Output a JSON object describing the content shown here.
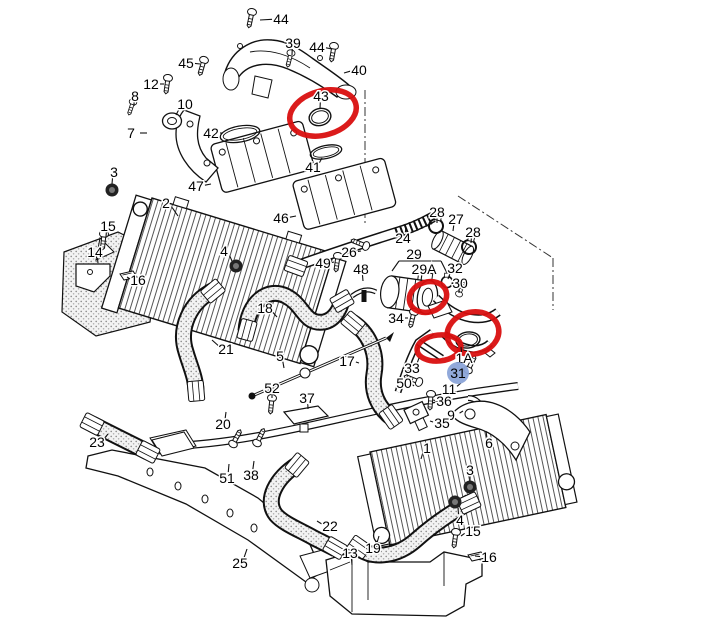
{
  "page": {
    "background": "#ffffff",
    "width": 720,
    "height": 622
  },
  "colors": {
    "line_art": "#111111",
    "annotation_red": "#d90f0f",
    "highlight_blue": "#8ba4d8",
    "label_text": "#000000"
  },
  "diagram": {
    "description": "Exploded parts diagram - charge air intercooler system with hoses, manifolds, throttle body and mounting hardware",
    "highlighted_label": {
      "text": "31",
      "x": 458,
      "y": 373,
      "r": 11
    },
    "labels": [
      {
        "t": "44",
        "x": 281,
        "y": 19,
        "tx": 260,
        "ty": 20
      },
      {
        "t": "39",
        "x": 293,
        "y": 43,
        "tx": 292,
        "ty": 55
      },
      {
        "t": "44",
        "x": 317,
        "y": 47,
        "tx": 332,
        "ty": 49
      },
      {
        "t": "40",
        "x": 359,
        "y": 70,
        "tx": 344,
        "ty": 73
      },
      {
        "t": "45",
        "x": 186,
        "y": 63,
        "tx": 200,
        "ty": 64
      },
      {
        "t": "12",
        "x": 151,
        "y": 84,
        "tx": 164,
        "ty": 84
      },
      {
        "t": "8",
        "x": 135,
        "y": 96,
        "tx": 134,
        "ty": 106
      },
      {
        "t": "10",
        "x": 185,
        "y": 104,
        "tx": 176,
        "ty": 115
      },
      {
        "t": "7",
        "x": 131,
        "y": 133,
        "tx": 147,
        "ty": 133
      },
      {
        "t": "42",
        "x": 211,
        "y": 133,
        "tx": 223,
        "ty": 133
      },
      {
        "t": "43",
        "x": 321,
        "y": 96,
        "tx": 320,
        "ty": 109
      },
      {
        "t": "41",
        "x": 313,
        "y": 167,
        "tx": 322,
        "ty": 158
      },
      {
        "t": "47",
        "x": 196,
        "y": 186,
        "tx": 211,
        "ty": 184
      },
      {
        "t": "3",
        "x": 114,
        "y": 172,
        "tx": 112,
        "ty": 184
      },
      {
        "t": "2",
        "x": 166,
        "y": 203,
        "tx": 178,
        "ty": 216
      },
      {
        "t": "15",
        "x": 108,
        "y": 226,
        "tx": 106,
        "ty": 237
      },
      {
        "t": "14",
        "x": 95,
        "y": 252,
        "tx": 98,
        "ty": 263
      },
      {
        "t": "16",
        "x": 138,
        "y": 280,
        "tx": 127,
        "ty": 277
      },
      {
        "t": "4",
        "x": 224,
        "y": 251,
        "tx": 232,
        "ty": 261
      },
      {
        "t": "46",
        "x": 281,
        "y": 218,
        "tx": 296,
        "ty": 216
      },
      {
        "t": "26",
        "x": 349,
        "y": 252,
        "tx": 361,
        "ty": 251
      },
      {
        "t": "24",
        "x": 403,
        "y": 238,
        "tx": 406,
        "ty": 227
      },
      {
        "t": "28",
        "x": 437,
        "y": 212,
        "tx": 437,
        "ty": 223
      },
      {
        "t": "27",
        "x": 456,
        "y": 219,
        "tx": 453,
        "ty": 231
      },
      {
        "t": "28",
        "x": 473,
        "y": 232,
        "tx": 471,
        "ty": 243
      },
      {
        "t": "49",
        "x": 323,
        "y": 263,
        "tx": 334,
        "ty": 262
      },
      {
        "t": "48",
        "x": 361,
        "y": 269,
        "tx": 363,
        "ty": 281
      },
      {
        "t": "29",
        "x": 414,
        "y": 254,
        "tx": 414,
        "ty": 260
      },
      {
        "t": "29A",
        "x": 424,
        "y": 269,
        "tx": 421,
        "ty": 281
      },
      {
        "t": "32",
        "x": 455,
        "y": 268,
        "tx": 448,
        "ty": 279
      },
      {
        "t": "30",
        "x": 460,
        "y": 283,
        "tx": 459,
        "ty": 293
      },
      {
        "t": "34",
        "x": 396,
        "y": 318,
        "tx": 408,
        "ty": 318
      },
      {
        "t": "18",
        "x": 265,
        "y": 308,
        "tx": 277,
        "ty": 317
      },
      {
        "t": "21",
        "x": 226,
        "y": 349,
        "tx": 212,
        "ty": 340
      },
      {
        "t": "5",
        "x": 280,
        "y": 356,
        "tx": 284,
        "ty": 368
      },
      {
        "t": "52",
        "x": 272,
        "y": 388,
        "tx": 272,
        "ty": 398
      },
      {
        "t": "17",
        "x": 347,
        "y": 361,
        "tx": 359,
        "ty": 363
      },
      {
        "t": "33",
        "x": 412,
        "y": 368,
        "tx": 419,
        "ty": 358
      },
      {
        "t": "50",
        "x": 404,
        "y": 383,
        "tx": 414,
        "ty": 386
      },
      {
        "t": "37",
        "x": 307,
        "y": 398,
        "tx": 308,
        "ty": 409
      },
      {
        "t": "36",
        "x": 444,
        "y": 401,
        "tx": 433,
        "ty": 400
      },
      {
        "t": "11",
        "x": 449,
        "y": 389,
        "tx": 461,
        "ty": 383
      },
      {
        "t": "9",
        "x": 451,
        "y": 415,
        "tx": 463,
        "ty": 411
      },
      {
        "t": "35",
        "x": 442,
        "y": 423,
        "tx": 430,
        "ty": 421
      },
      {
        "t": "1A",
        "x": 464,
        "y": 358,
        "tx": 461,
        "ty": 347
      },
      {
        "t": "6",
        "x": 489,
        "y": 443,
        "tx": 486,
        "ty": 431
      },
      {
        "t": "20",
        "x": 223,
        "y": 424,
        "tx": 226,
        "ty": 412
      },
      {
        "t": "23",
        "x": 97,
        "y": 442,
        "tx": 108,
        "ty": 434
      },
      {
        "t": "51",
        "x": 227,
        "y": 478,
        "tx": 229,
        "ty": 464
      },
      {
        "t": "38",
        "x": 251,
        "y": 475,
        "tx": 254,
        "ty": 461
      },
      {
        "t": "22",
        "x": 330,
        "y": 526,
        "tx": 317,
        "ty": 521
      },
      {
        "t": "25",
        "x": 240,
        "y": 563,
        "tx": 247,
        "ty": 549
      },
      {
        "t": "13",
        "x": 350,
        "y": 553,
        "tx": 352,
        "ty": 565
      },
      {
        "t": "19",
        "x": 373,
        "y": 548,
        "tx": 379,
        "ty": 536
      },
      {
        "t": "1",
        "x": 427,
        "y": 448,
        "tx": 421,
        "ty": 459
      },
      {
        "t": "3",
        "x": 470,
        "y": 470,
        "tx": 470,
        "ty": 481
      },
      {
        "t": "4",
        "x": 460,
        "y": 520,
        "tx": 458,
        "ty": 508
      },
      {
        "t": "15",
        "x": 473,
        "y": 531,
        "tx": 461,
        "ty": 536
      },
      {
        "t": "16",
        "x": 489,
        "y": 557,
        "tx": 475,
        "ty": 556
      }
    ],
    "extra_lines": [
      {
        "x1": 399,
        "y1": 261,
        "x2": 441,
        "y2": 261
      },
      {
        "x1": 399,
        "y1": 261,
        "x2": 392,
        "y2": 271
      },
      {
        "x1": 441,
        "y1": 261,
        "x2": 447,
        "y2": 273
      }
    ],
    "annotations": [
      {
        "type": "ellipse",
        "cx": 323,
        "cy": 113,
        "rx": 34,
        "ry": 22,
        "rot": -16
      },
      {
        "type": "ellipse",
        "cx": 428,
        "cy": 297,
        "rx": 19,
        "ry": 15,
        "rot": -18
      },
      {
        "type": "ellipse",
        "cx": 473,
        "cy": 333,
        "rx": 26,
        "ry": 21,
        "rot": -12
      },
      {
        "type": "ellipse",
        "cx": 439,
        "cy": 348,
        "rx": 22,
        "ry": 13,
        "rot": -6
      }
    ]
  }
}
